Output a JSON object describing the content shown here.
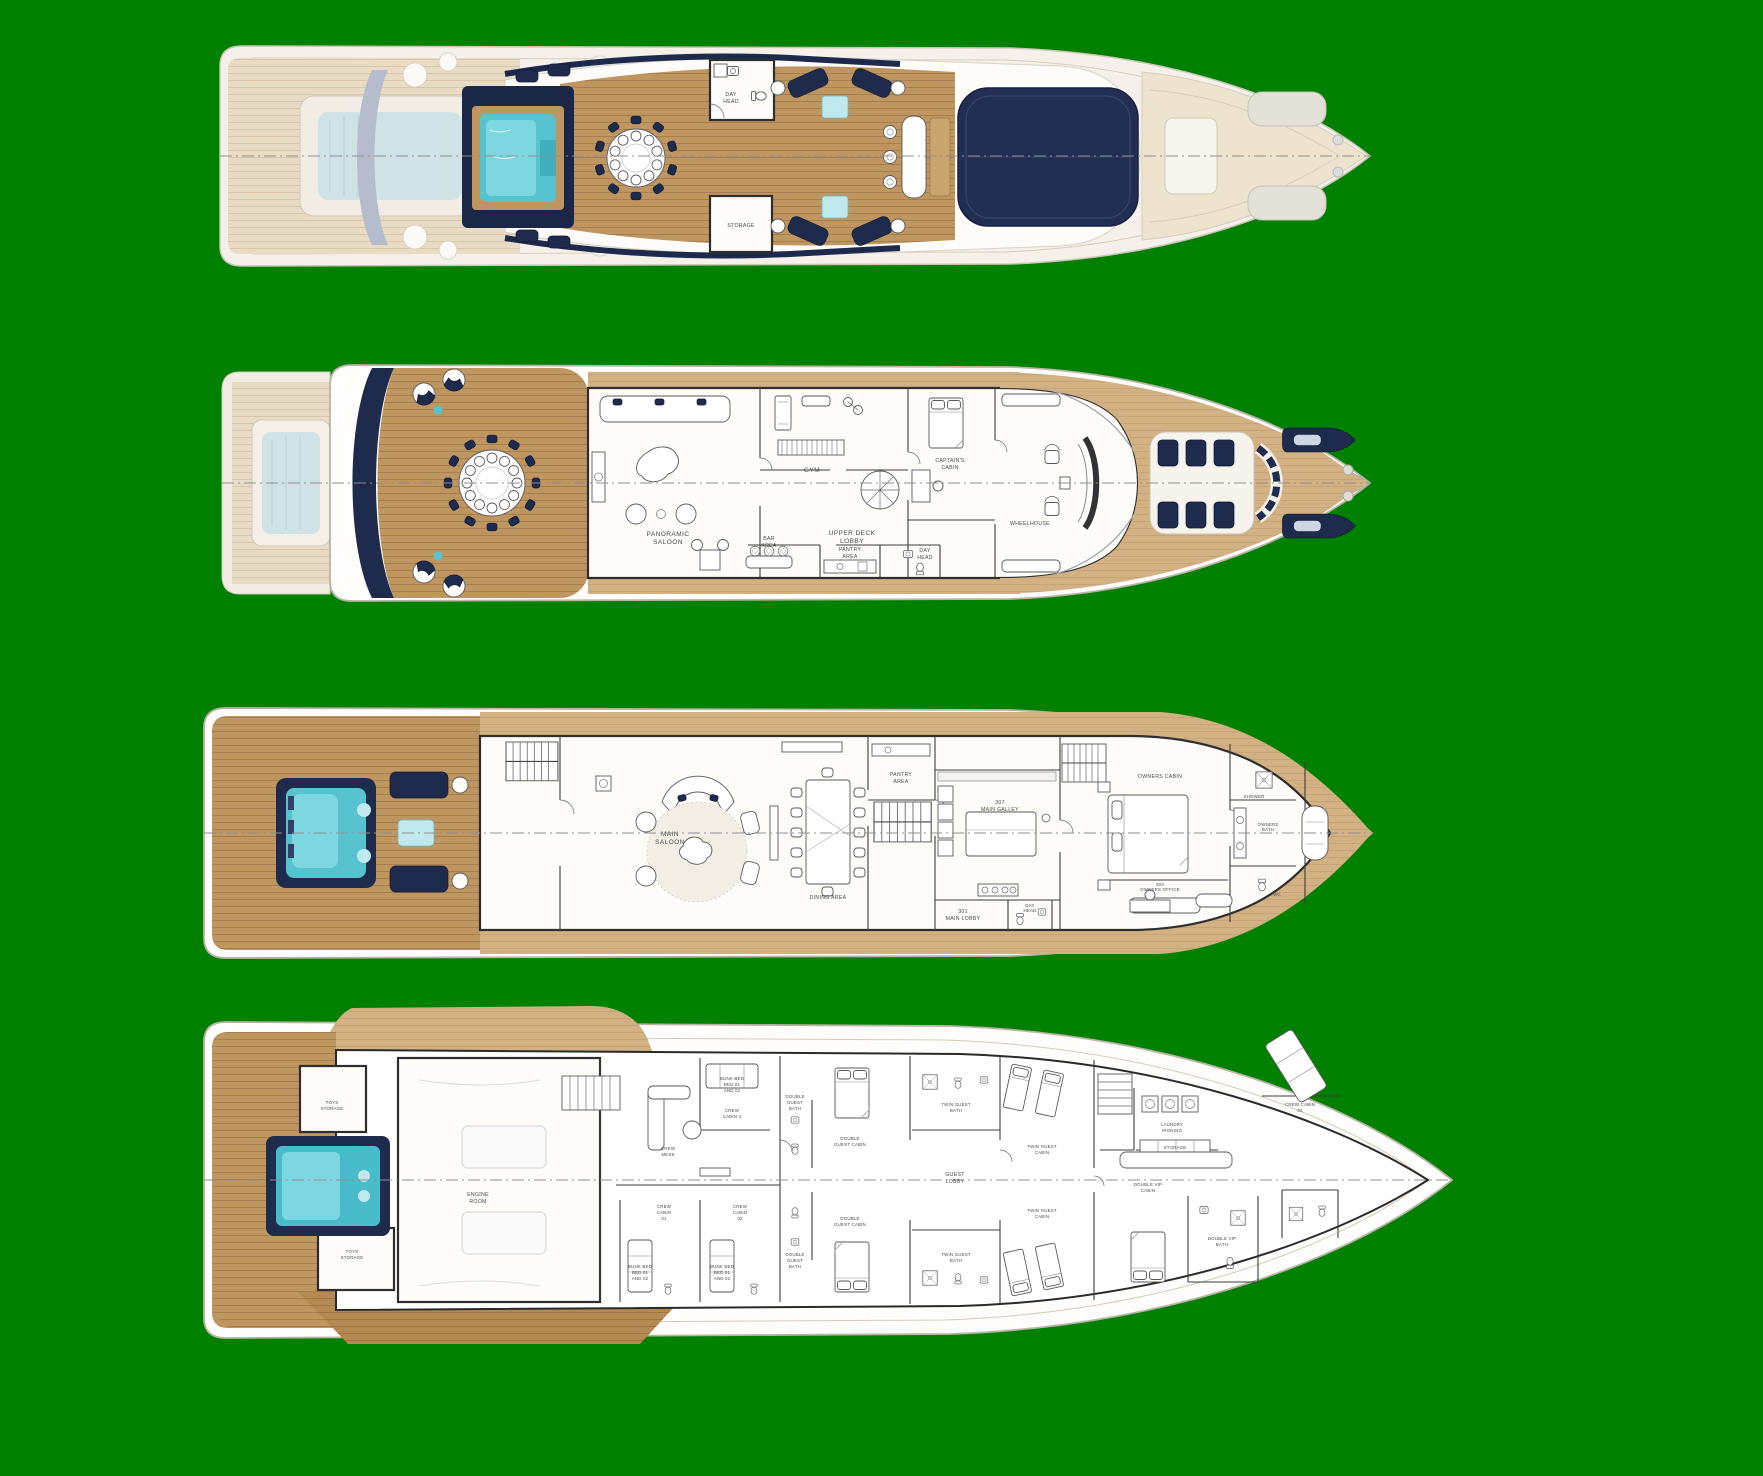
{
  "title": "yacht-general-arrangement-four-deck-plans",
  "colors": {
    "bg": "#008000",
    "navy": "#1f2b4d",
    "hardtop": "#232f52",
    "teal": "#56c3cf",
    "teal_light": "#8adde6",
    "wood": "#bf965f",
    "wood_light": "#d2b283",
    "wood_pale": "#e9dcc4",
    "wood_dark": "#b58a52",
    "line": "#2e2e2e",
    "label": "#4a4a4a",
    "hull_stroke": "#b9b3a8"
  },
  "decks": {
    "sun_deck": {
      "labels": {
        "day_head": [
          "DAY",
          "HEAD"
        ],
        "storage": [
          "STORAGE"
        ]
      }
    },
    "upper_deck": {
      "labels": {
        "panoramic_saloon": [
          "PANORAMIC",
          "SALOON"
        ],
        "gym": [
          "GYM"
        ],
        "captains_cabin": [
          "CAPTAIN'S",
          "CABIN"
        ],
        "upper_deck_lobby": [
          "UPPER DECK",
          "LOBBY"
        ],
        "wheelhouse": [
          "WHEELHOUSE"
        ],
        "bar_area": [
          "BAR",
          "AREA"
        ],
        "pantry_area": [
          "PANTRY",
          "AREA"
        ],
        "day_head": [
          "DAY",
          "HEAD"
        ]
      }
    },
    "main_deck": {
      "labels": {
        "main_saloon": [
          "MAIN",
          "SALOON"
        ],
        "dining_area": [
          "DINING AREA"
        ],
        "pantry_area": [
          "PANTRY",
          "AREA"
        ],
        "main_galley": [
          "307",
          "MAIN GALLEY"
        ],
        "main_lobby": [
          "301",
          "MAIN LOBBY"
        ],
        "day_head": [
          "DAY",
          "HEAD"
        ],
        "owners_cabin": [
          "OWNERS CABIN"
        ],
        "owners_office": [
          "303",
          "OWNERS OFFICE"
        ],
        "owners_bath": [
          "OWNERS",
          "BATH"
        ],
        "shower": [
          "SHOWER"
        ],
        "wc": [
          "WC"
        ]
      }
    },
    "lower_deck": {
      "labels": {
        "toys_storage_aft": [
          "TOYS",
          "STORAGE"
        ],
        "toys_storage_fwd": [
          "TOYS",
          "STORAGE"
        ],
        "engine_room": [
          "ENGINE",
          "ROOM"
        ],
        "crew_mess": [
          "CREW",
          "MESS"
        ],
        "crew_cabin_3": [
          "CREW",
          "CABIN 3"
        ],
        "crew_cabin_3_bunk": [
          "BUNK BED",
          "BED 01",
          "AND 02"
        ],
        "crew_cabin_01": [
          "CREW",
          "CABIN",
          "01"
        ],
        "crew_cabin_02": [
          "CREW",
          "CABIN",
          "02"
        ],
        "crew_cabin_01_bunk": [
          "BUNK BED",
          "BED 01",
          "AND 02"
        ],
        "crew_cabin_02_bunk": [
          "BUNK BED",
          "BED 01",
          "AND 02"
        ],
        "double_guest_bath_port": [
          "DOUBLE",
          "GUEST",
          "BATH"
        ],
        "double_guest_cabin_port": [
          "DOUBLE",
          "GUEST CABIN"
        ],
        "double_guest_bath_stbd": [
          "DOUBLE",
          "GUEST",
          "BATH"
        ],
        "double_guest_cabin_stbd": [
          "DOUBLE",
          "GUEST CABIN"
        ],
        "guest_lobby": [
          "GUEST",
          "LOBBY"
        ],
        "twin_guest_bath_port": [
          "TWIN GUEST",
          "BATH"
        ],
        "twin_guest_cabin_port": [
          "TWIN GUEST",
          "CABIN"
        ],
        "twin_guest_bath_stbd": [
          "TWIN GUEST",
          "BATH"
        ],
        "twin_guest_cabin_stbd": [
          "TWIN GUEST",
          "CABIN"
        ],
        "laundry": [
          "LAUNDRY",
          "IRONING"
        ],
        "storage": [
          "STORAGE"
        ],
        "double_vip_cabin": [
          "DOUBLE VIP",
          "CABIN"
        ],
        "double_vip_bath": [
          "DOUBLE VIP",
          "BATH"
        ],
        "crew_cabin_04": [
          "CREW CABIN",
          "04"
        ]
      }
    }
  }
}
